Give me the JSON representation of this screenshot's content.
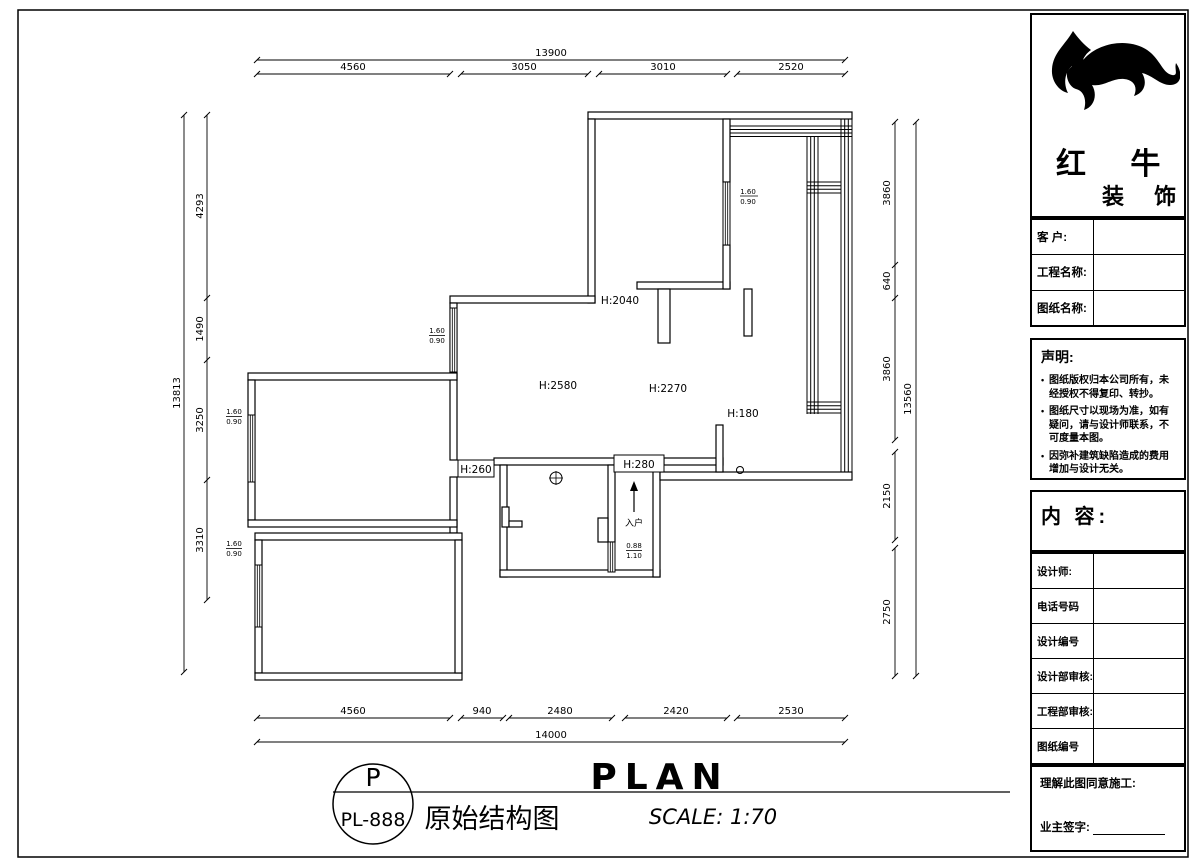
{
  "sheet": {
    "bg": "#ffffff",
    "line_color": "#000000"
  },
  "plan": {
    "heights": {
      "top_bedroom_door": "H:2040",
      "living": "H:2580",
      "dining": "H:2270",
      "hall_beam": "H:180",
      "passage_beam": "H:260",
      "entry_beam": "H:280"
    },
    "entry_label": "入户",
    "windows": [
      {
        "id": "top-bedroom-window",
        "num": "1.60",
        "den": "0.90"
      },
      {
        "id": "living-window",
        "num": "1.60",
        "den": "0.90"
      },
      {
        "id": "bedroom1-window",
        "num": "1.60",
        "den": "0.90"
      },
      {
        "id": "bedroom2-window",
        "num": "1.60",
        "den": "0.90"
      },
      {
        "id": "entry-window",
        "num": "0.88",
        "den": "1.10"
      }
    ]
  },
  "dimensions": {
    "top": {
      "total": "13900",
      "segments": [
        "4560",
        "3050",
        "3010",
        "2520"
      ]
    },
    "bottom": {
      "total": "14000",
      "segments": [
        "4560",
        "940",
        "2480",
        "2420",
        "2530"
      ]
    },
    "left": {
      "total": "13813",
      "segments": [
        "4293",
        "1490",
        "3250",
        "3310"
      ]
    },
    "right": {
      "total": "13560",
      "segments": [
        "3860",
        "640",
        "3860",
        "2150",
        "2750"
      ]
    }
  },
  "title_block": {
    "brand_line1": "红 牛",
    "brand_line2": "装 饰",
    "fields": [
      {
        "label": "客  户:",
        "value": ""
      },
      {
        "label": "工程名称:",
        "value": ""
      },
      {
        "label": "图纸名称:",
        "value": ""
      }
    ],
    "statement": {
      "title": "声明:",
      "items": [
        "图纸版权归本公司所有，未经授权不得复印、转抄。",
        "图纸尺寸以现场为准，如有疑问，请与设计师联系，不可度量本图。",
        "因弥补建筑缺陷造成的费用增加与设计无关。"
      ]
    },
    "content_label": "内 容:",
    "rows": [
      {
        "label": "设计师:",
        "value": ""
      },
      {
        "label": "电话号码",
        "value": ""
      },
      {
        "label": "设计编号",
        "value": ""
      },
      {
        "label": "设计部审核:",
        "value": ""
      },
      {
        "label": "工程部审核:",
        "value": ""
      },
      {
        "label": "图纸编号",
        "value": ""
      }
    ],
    "approval": {
      "line1": "理解此图同意施工:",
      "line2": "业主签字:"
    }
  },
  "footer": {
    "stamp_letter": "P",
    "stamp_code": "PL-888",
    "drawing_title_cn": "原始结构图",
    "drawing_title_en": "PLAN",
    "scale": "SCALE: 1:70"
  }
}
